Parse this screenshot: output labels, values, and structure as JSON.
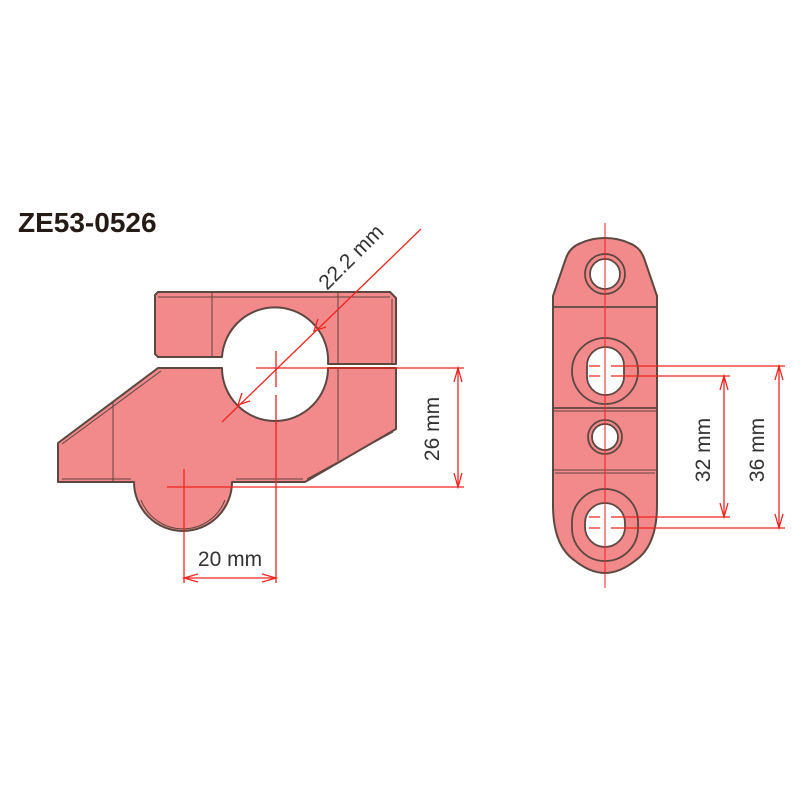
{
  "title": "ZE53-0526",
  "colors": {
    "background": "#ffffff",
    "part_fill": "#f2898b",
    "outline": "#5c4741",
    "dimension_red": "#f0251f",
    "text_dark": "#333333",
    "title_color": "#251b16"
  },
  "dimensions": {
    "bore_diameter": "22.2 mm",
    "riser_height": "26 mm",
    "riser_setback": "20 mm",
    "hole_spacing_min": "32 mm",
    "hole_spacing_max": "36 mm"
  }
}
